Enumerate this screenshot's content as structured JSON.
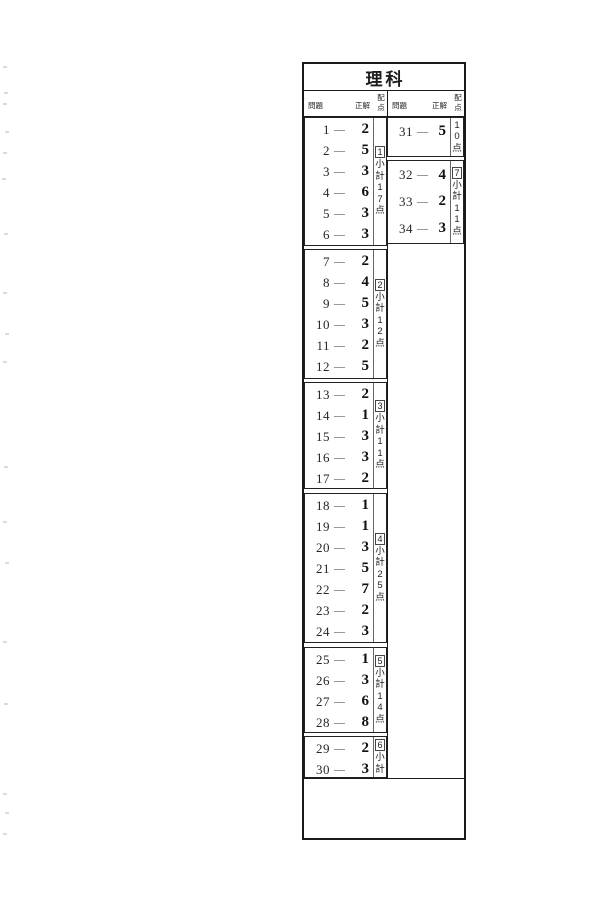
{
  "title": "理科",
  "header": {
    "question": "問題",
    "answer": "正解",
    "points": "配点"
  },
  "separator": "—",
  "left_sections": [
    {
      "box": "1",
      "subtotal": "小計",
      "points": "17点",
      "rows": [
        {
          "q": "1",
          "a": "2"
        },
        {
          "q": "2",
          "a": "5"
        },
        {
          "q": "3",
          "a": "3"
        },
        {
          "q": "4",
          "a": "6"
        },
        {
          "q": "5",
          "a": "3"
        },
        {
          "q": "6",
          "a": "3"
        }
      ]
    },
    {
      "box": "2",
      "subtotal": "小計",
      "points": "12点",
      "rows": [
        {
          "q": "7",
          "a": "2"
        },
        {
          "q": "8",
          "a": "4"
        },
        {
          "q": "9",
          "a": "5"
        },
        {
          "q": "10",
          "a": "3"
        },
        {
          "q": "11",
          "a": "2"
        },
        {
          "q": "12",
          "a": "5"
        }
      ]
    },
    {
      "box": "3",
      "subtotal": "小計",
      "points": "11点",
      "rows": [
        {
          "q": "13",
          "a": "2"
        },
        {
          "q": "14",
          "a": "1"
        },
        {
          "q": "15",
          "a": "3"
        },
        {
          "q": "16",
          "a": "3"
        },
        {
          "q": "17",
          "a": "2"
        }
      ]
    },
    {
      "box": "4",
      "subtotal": "小計",
      "points": "25点",
      "rows": [
        {
          "q": "18",
          "a": "1"
        },
        {
          "q": "19",
          "a": "1"
        },
        {
          "q": "20",
          "a": "3"
        },
        {
          "q": "21",
          "a": "5"
        },
        {
          "q": "22",
          "a": "7"
        },
        {
          "q": "23",
          "a": "2"
        },
        {
          "q": "24",
          "a": "3"
        }
      ]
    },
    {
      "box": "5",
      "subtotal": "小計",
      "points": "14点",
      "rows": [
        {
          "q": "25",
          "a": "1"
        },
        {
          "q": "26",
          "a": "3"
        },
        {
          "q": "27",
          "a": "6"
        },
        {
          "q": "28",
          "a": "8"
        }
      ]
    },
    {
      "box": "6",
      "subtotal": "小計",
      "points": "",
      "rows": [
        {
          "q": "29",
          "a": "2"
        },
        {
          "q": "30",
          "a": "3"
        }
      ]
    }
  ],
  "right_sections": [
    {
      "box": "",
      "subtotal": "",
      "points": "10点",
      "rows": [
        {
          "q": "31",
          "a": "5"
        }
      ]
    },
    {
      "box": "7",
      "subtotal": "小計",
      "points": "11点",
      "rows": [
        {
          "q": "32",
          "a": "4"
        },
        {
          "q": "33",
          "a": "2"
        },
        {
          "q": "34",
          "a": "3"
        }
      ]
    }
  ],
  "colors": {
    "paper": "#ffffff",
    "ink": "#1c1c1c",
    "border": "#1a1a1a"
  }
}
